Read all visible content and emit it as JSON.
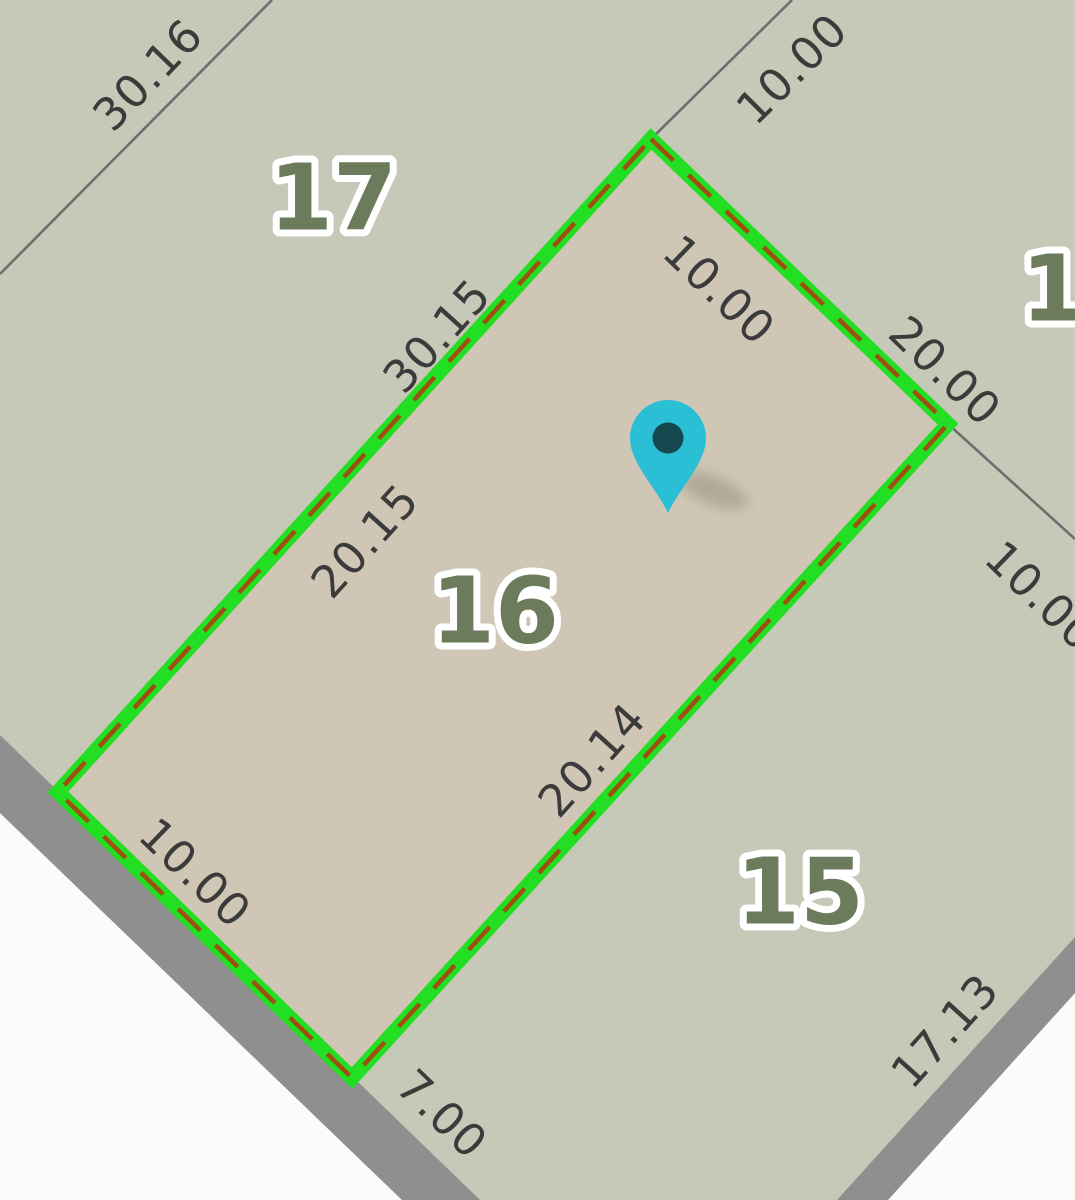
{
  "map": {
    "selected_parcel": {
      "number": "16",
      "side_lengths": {
        "nw": "20.15",
        "ne": "10.00",
        "se": "20.14",
        "sw": "10.00"
      }
    },
    "adjacent_parcels": {
      "northwest": "17",
      "southeast": "15",
      "northeast_partial": "1"
    },
    "marker": {
      "type": "location-pin"
    }
  },
  "labels": {
    "parcel_17": "17",
    "parcel_16": "16",
    "parcel_15": "15",
    "parcel_ne_partial": "1",
    "dim_nw_outer": "30.16",
    "dim_n_extension": "10.00",
    "dim_nw_total": "30.15",
    "dim_ne_inner": "10.00",
    "dim_ne_outer": "20.00",
    "dim_e_extension": "10.00",
    "dim_nw_inner": "20.15",
    "dim_se_inner": "20.14",
    "dim_sw_inner": "10.00",
    "dim_road_left": "7.00",
    "dim_road_right": "17.13"
  },
  "colors": {
    "parcel_fill": "#c6c9b7",
    "selected_parcel_fill": "#cfc6b5",
    "selection_border": "#23df23",
    "selection_dash": "#9d500f",
    "boundary_line": "#6e6e6e",
    "road_band": "#8f8f90",
    "road_surface": "#fbfbf9",
    "parcel_number_text": "#6b7b5b",
    "parcel_number_halo": "#ffffff",
    "dimension_text": "#3b3b3b",
    "marker_fill": "#2bbfd6",
    "marker_center": "#16494f"
  }
}
